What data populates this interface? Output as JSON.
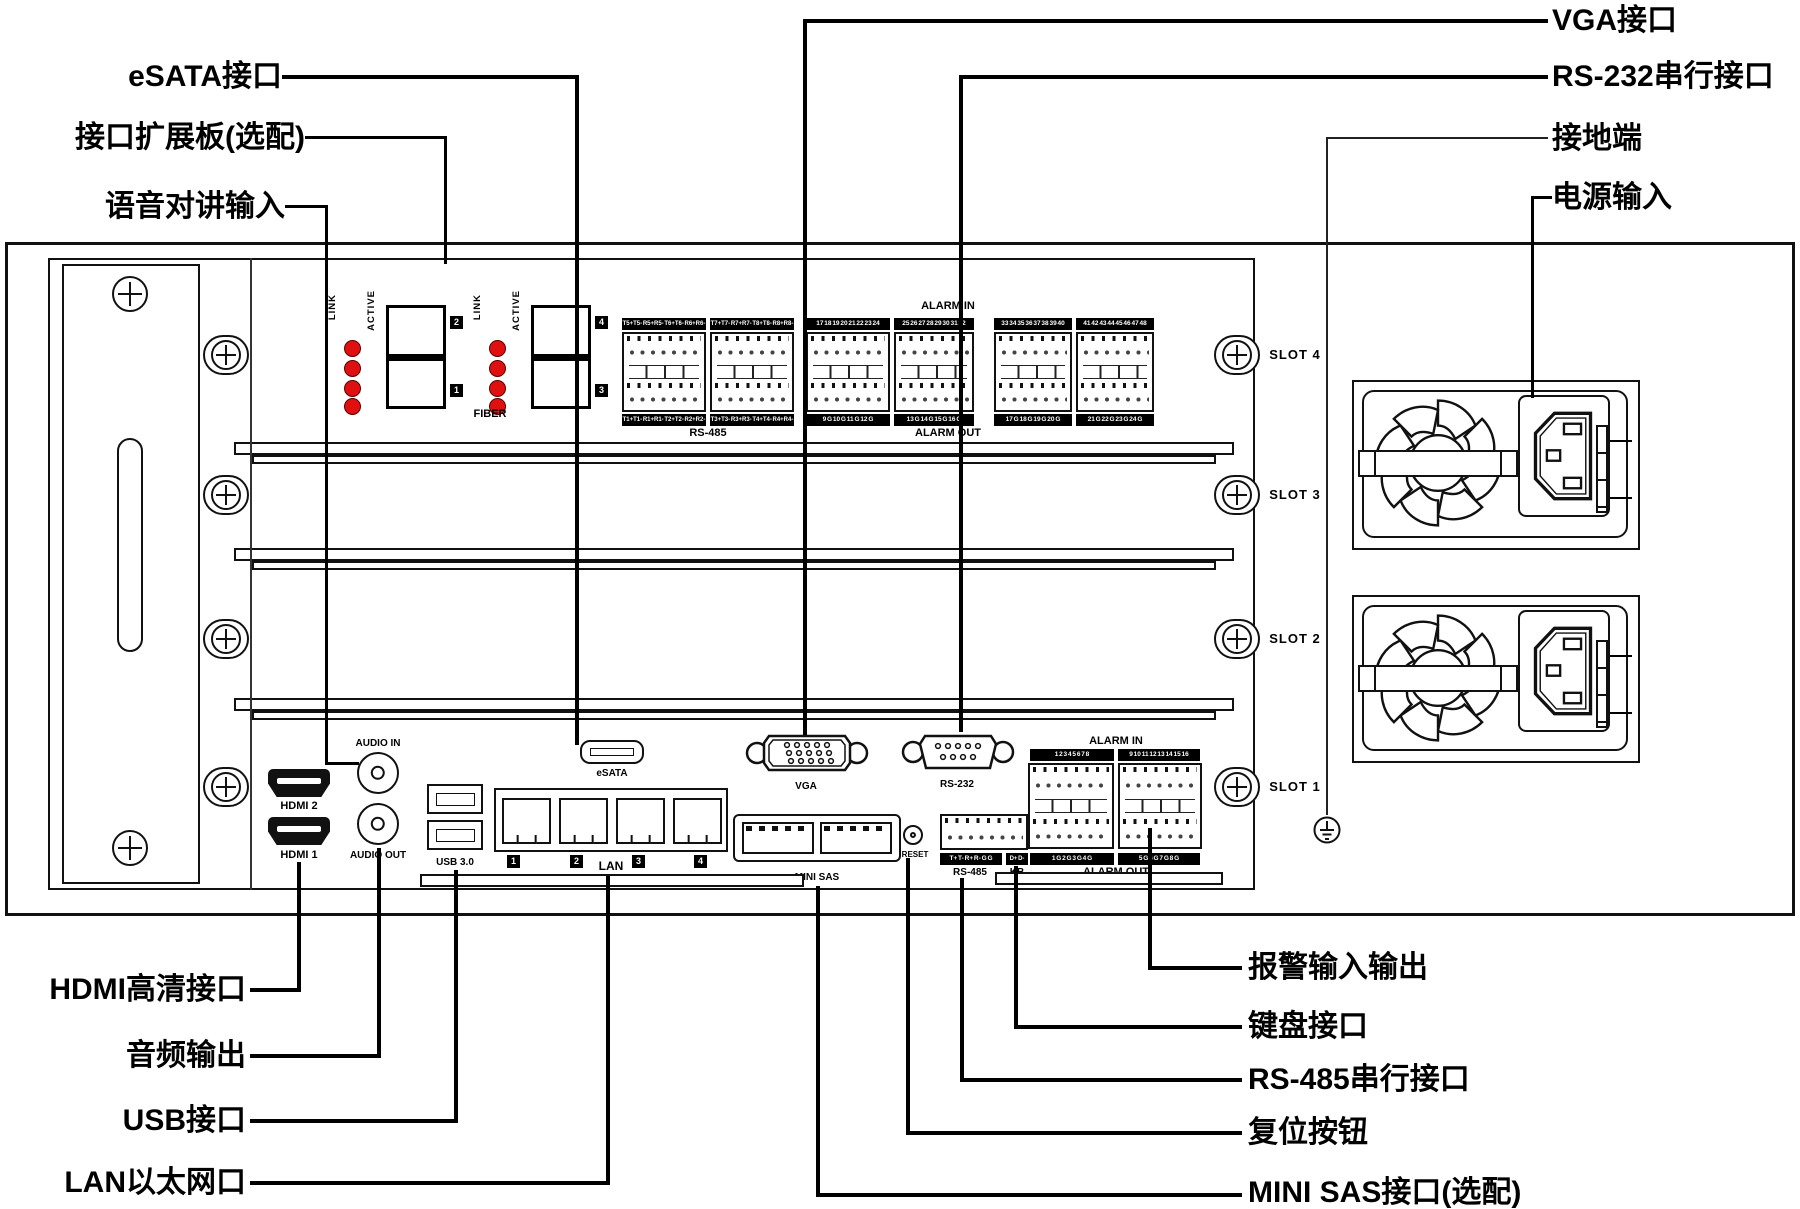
{
  "callouts": {
    "top_left": [
      "eSATA接口",
      "接口扩展板(选配)",
      "语音对讲输入"
    ],
    "top_right": [
      "VGA接口",
      "RS-232串行接口",
      "接地端",
      "电源输入"
    ],
    "bottom_left": [
      "HDMI高清接口",
      "音频输出",
      "USB接口",
      "LAN以太网口"
    ],
    "bottom_right": [
      "报警输入输出",
      "键盘接口",
      "RS-485串行接口",
      "复位按钮",
      "MINI SAS接口(选配)"
    ]
  },
  "panel": {
    "slot_labels": [
      "SLOT 4",
      "SLOT 3",
      "SLOT 2",
      "SLOT 1"
    ],
    "expansion_board": {
      "fiber": {
        "label": "FIBER",
        "link_label": "LINK",
        "active_label": "ACTIVE",
        "module_tags": [
          "2",
          "1",
          "4",
          "3"
        ]
      },
      "rs485": {
        "label": "RS-485",
        "top_strips": [
          "T5+T5- R5+R5- T6+T6- R6+R6-",
          "T7+T7- R7+R7- T8+T8- R8+R8-"
        ],
        "bottom_strips": [
          "T1+T1- R1+R1- T2+T2- R2+R2-",
          "T3+T3- R3+R3- T4+T4- R4+R4-"
        ]
      },
      "alarm_in": {
        "label": "ALARM IN",
        "strips": [
          "17 18 19 20 21 22 23 24",
          "25 26 27 28 29 30 31 32",
          "33 34 35 36 37 38 39 40",
          "41 42 43 44 45 46 47 48"
        ]
      },
      "alarm_out": {
        "label": "ALARM OUT",
        "strips": [
          "9 G 10 G 11 G 12 G",
          "13 G 14 G 15 G 16 G",
          "17 G 18 G 19 G 20 G",
          "21 G 22 G 23 G 24 G"
        ]
      }
    },
    "main_board": {
      "hdmi2_label": "HDMI 2",
      "hdmi1_label": "HDMI 1",
      "audio_in_label": "AUDIO IN",
      "audio_out_label": "AUDIO OUT",
      "usb_label": "USB 3.0",
      "lan": {
        "label": "LAN",
        "port_numbers": [
          "1",
          "2",
          "3",
          "4"
        ]
      },
      "esata_label": "eSATA",
      "vga_label": "VGA",
      "rs232_label": "RS-232",
      "minisas_label": "MINI SAS",
      "reset_label": "RESET",
      "rs485": {
        "label": "RS-485",
        "strip": "T+ T- R+ R- G G"
      },
      "kb": {
        "label": "KB",
        "strip": "D+ D-"
      },
      "alarm_in": {
        "label": "ALARM IN",
        "strips": [
          "1 2 3 4 5 6 7 8",
          "9 10 11 12 13 14 15 16"
        ]
      },
      "alarm_out": {
        "label": "ALARM OUT",
        "strips": [
          "1 G 2 G 3 G 4 G",
          "5 G 6 G 7 G 8 G"
        ]
      }
    },
    "colors": {
      "led_red": "#e01010",
      "line": "#000000",
      "panel_bg": "#ffffff"
    }
  }
}
